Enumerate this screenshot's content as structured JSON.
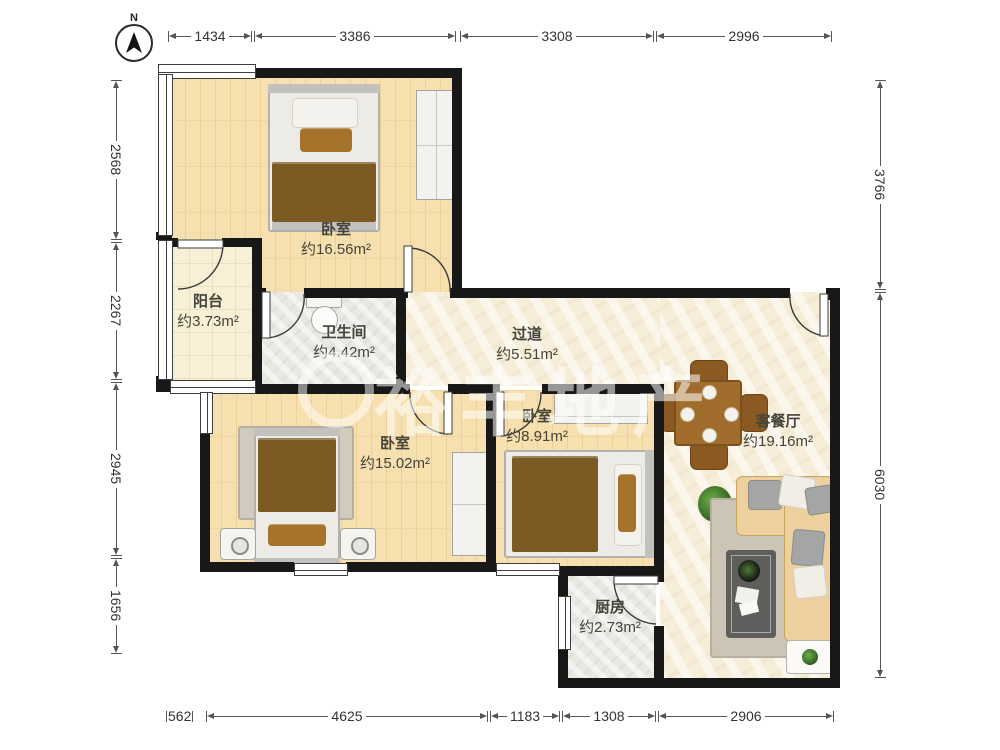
{
  "compass": {
    "label": "N"
  },
  "watermark": {
    "text": "裕丰地产"
  },
  "rooms": {
    "bedroom_top": {
      "name": "卧室",
      "area": "约16.56m²"
    },
    "balcony": {
      "name": "阳台",
      "area": "约3.73m²"
    },
    "bathroom": {
      "name": "卫生间",
      "area": "约4.42m²"
    },
    "hallway": {
      "name": "过道",
      "area": "约5.51m²"
    },
    "bedroom_mid": {
      "name": "卧室",
      "area": "约15.02m²"
    },
    "bedroom_small": {
      "name": "卧室",
      "area": "约8.91m²"
    },
    "living_dining": {
      "name": "客餐厅",
      "area": "约19.16m²"
    },
    "kitchen": {
      "name": "厨房",
      "area": "约2.73m²"
    }
  },
  "dimensions": {
    "top": [
      "1434",
      "3386",
      "3308",
      "2996"
    ],
    "left": [
      "2568",
      "2267",
      "2945",
      "1656"
    ],
    "right": [
      "3766",
      "6030"
    ],
    "bottom": [
      "562",
      "4625",
      "1183",
      "1308",
      "2906"
    ]
  },
  "colors": {
    "wall": "#181818",
    "wood_floor": "#f7e0af",
    "tile_floor": "#f8efd7",
    "gray_floor": "#e9e8e3",
    "cream_floor": "#f7eed9",
    "blanket": "#7b5a24",
    "sofa": "#edd09e",
    "dim_text": "#333333",
    "label_text": "#45443a"
  }
}
